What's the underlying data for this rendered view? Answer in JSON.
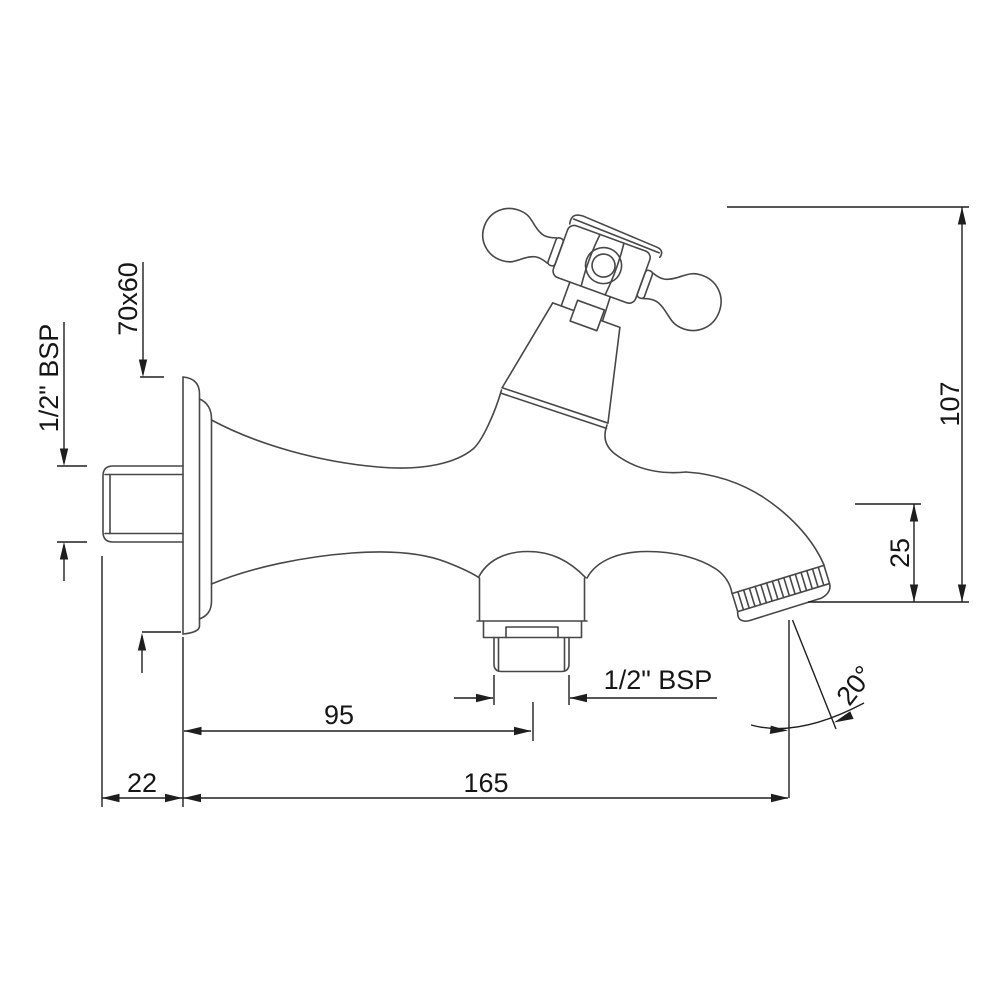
{
  "drawing": {
    "type": "technical-dimension-drawing",
    "subject": "wall-mounted bib cock with crutch cross handle",
    "background_color": "#ffffff",
    "outline_color": "#474747",
    "dimension_color": "#1e1e1e",
    "labels": {
      "flange_size": "70x60",
      "inlet_thread": "1/2\" BSP",
      "outlet_thread": "1/2\" BSP",
      "total_height": "107",
      "spout_clearance": "25",
      "wall_to_outlet": "95",
      "total_length": "165",
      "wall_projection": "22",
      "spout_angle": "20°"
    }
  }
}
